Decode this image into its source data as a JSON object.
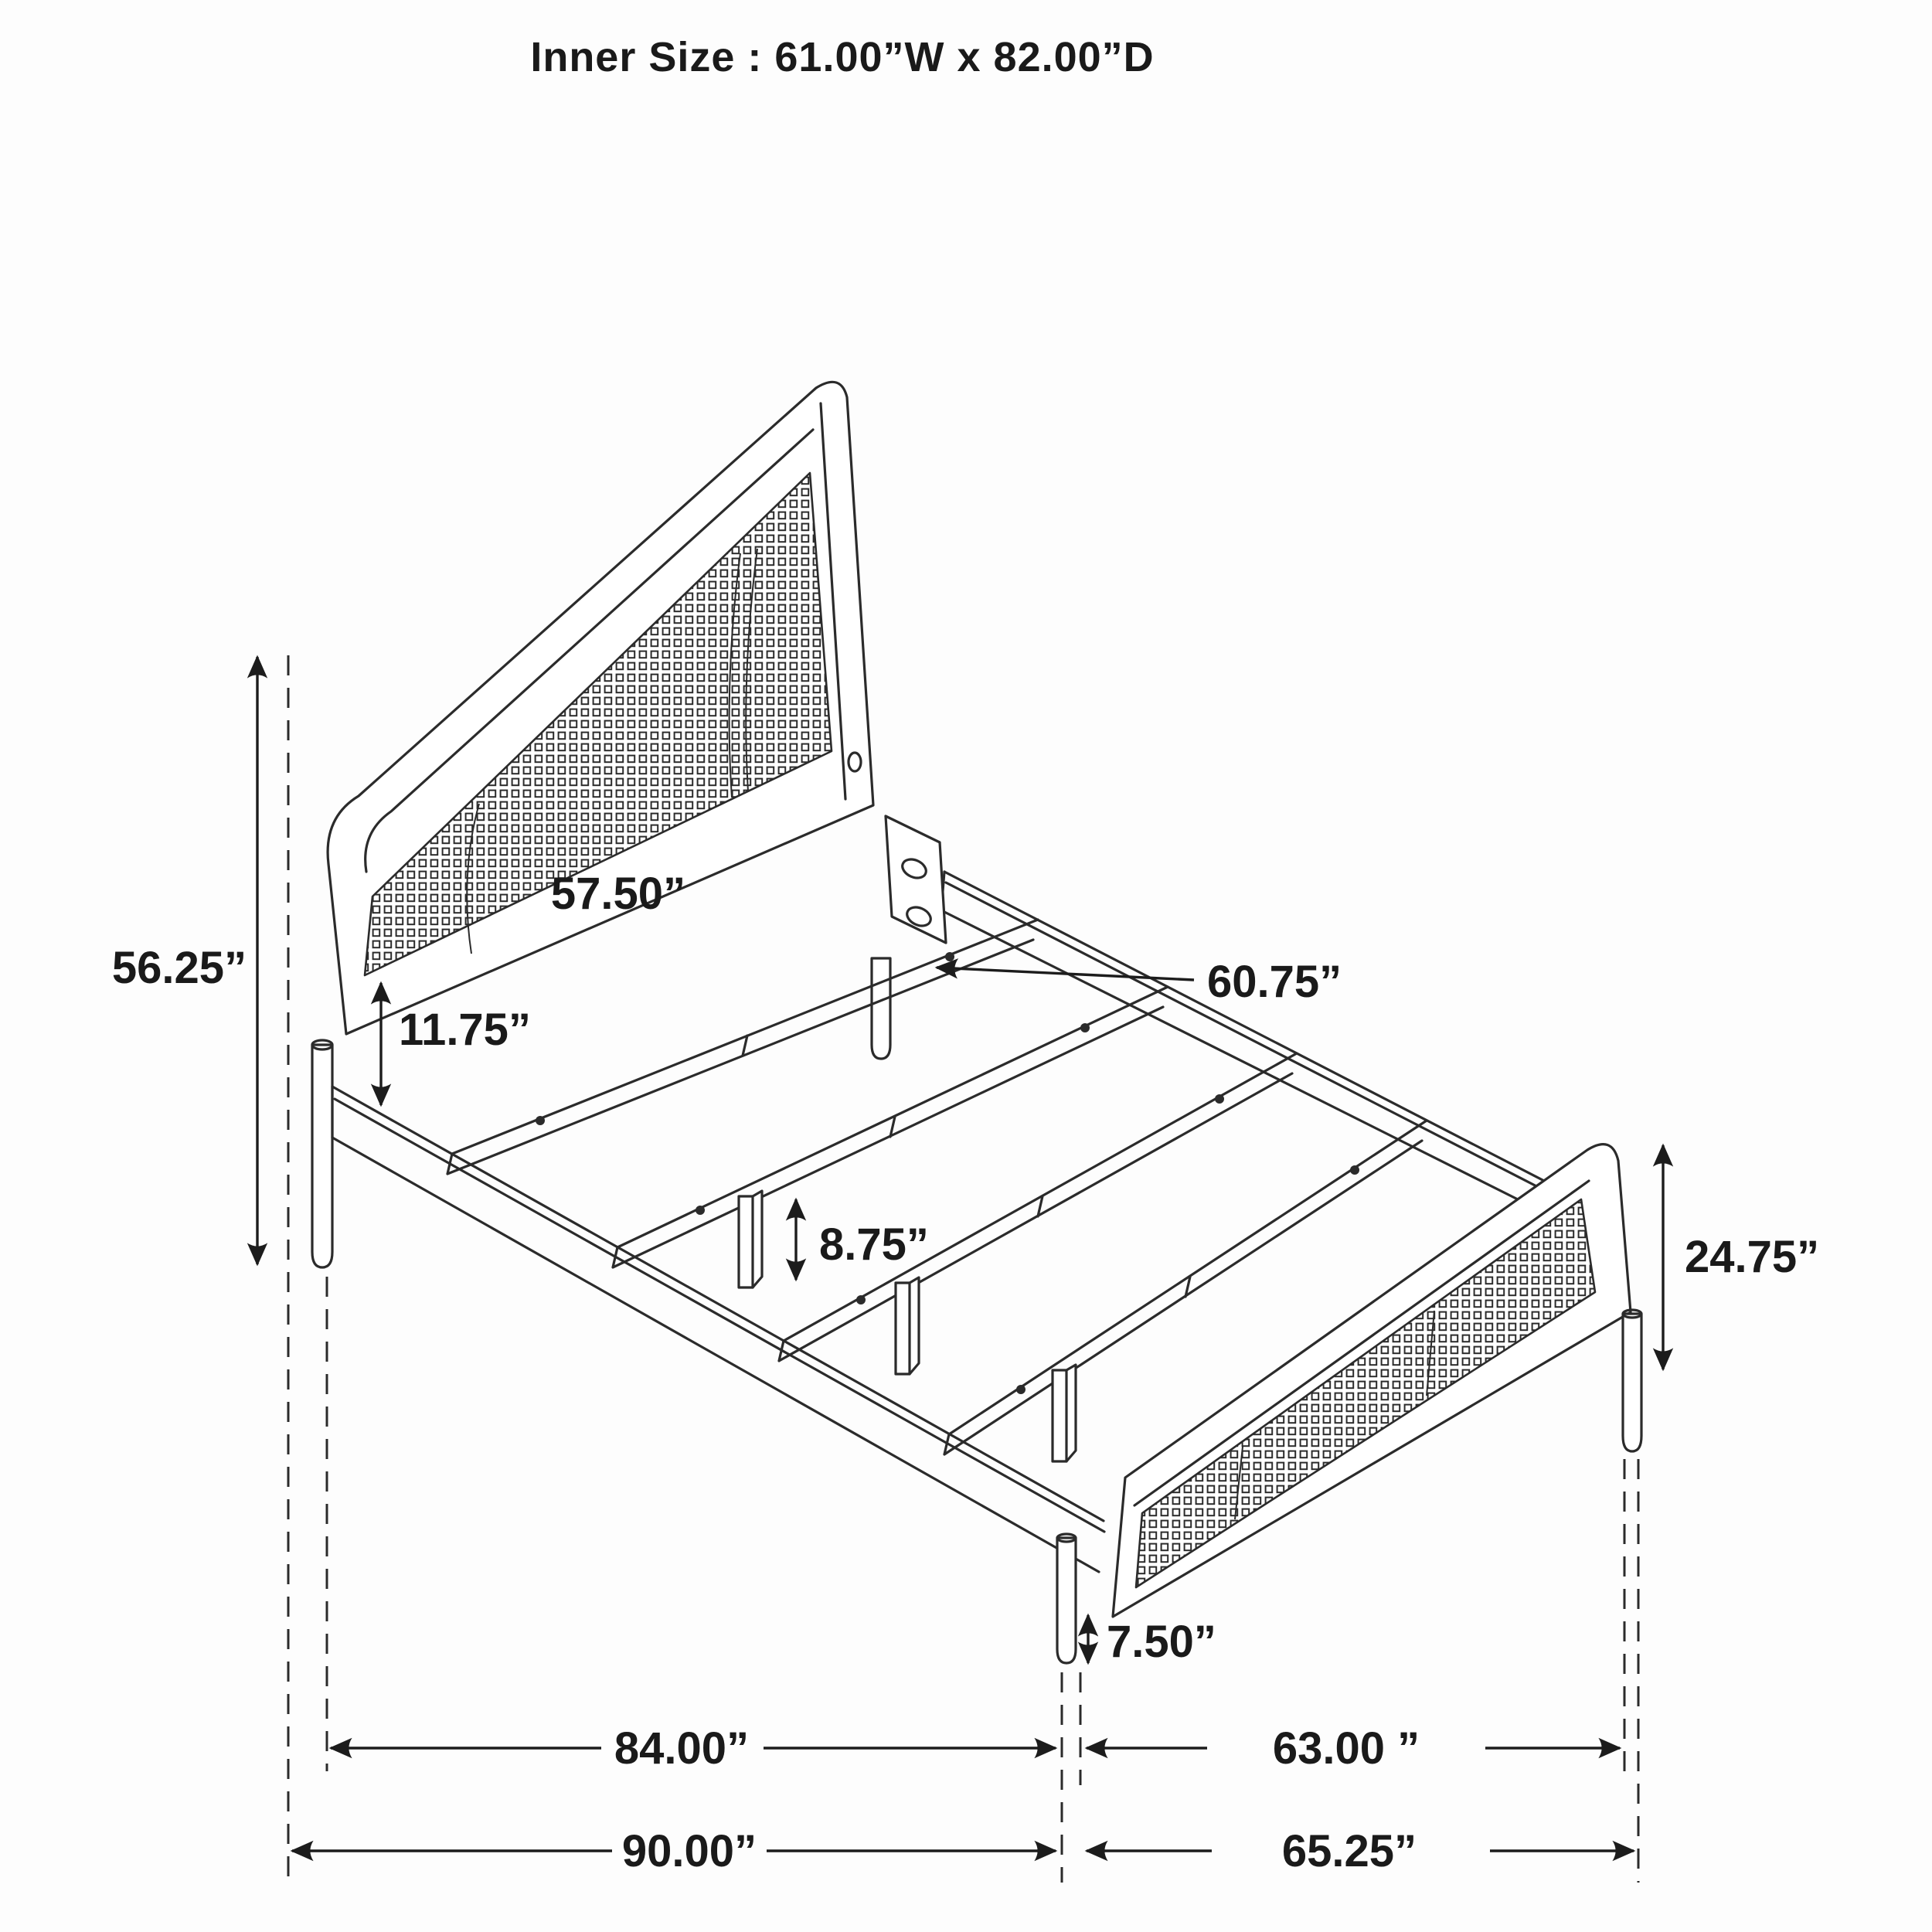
{
  "title": "Inner Size : 61.00”W x 82.00”D",
  "inner_size": {
    "width_in": 61.0,
    "depth_in": 82.0
  },
  "diagram": {
    "type": "bed-frame-dimension-drawing",
    "units": "inches",
    "style": "black line art, isometric view, cane mesh headboard and footboard"
  },
  "dims": {
    "headboard_height": {
      "label": "56.25”",
      "value": 56.25
    },
    "headboard_rail_width": {
      "label": "57.50”",
      "value": 57.5
    },
    "headboard_rail_gap": {
      "label": "11.75”",
      "value": 11.75
    },
    "slat_length": {
      "label": "60.75”",
      "value": 60.75
    },
    "center_leg_height": {
      "label": "8.75”",
      "value": 8.75
    },
    "footboard_height": {
      "label": "24.75”",
      "value": 24.75
    },
    "footboard_leg_height": {
      "label": "7.50”",
      "value": 7.5
    },
    "rail_length": {
      "label": "84.00”",
      "value": 84.0
    },
    "foot_width_inner": {
      "label": "63.00 ”",
      "value": 63.0
    },
    "overall_length": {
      "label": "90.00”",
      "value": 90.0
    },
    "foot_width_overall": {
      "label": "65.25”",
      "value": 65.25
    }
  },
  "colors": {
    "background": "#fdfdfd",
    "line": "#2b2b2b",
    "text": "#1a1a1a"
  }
}
